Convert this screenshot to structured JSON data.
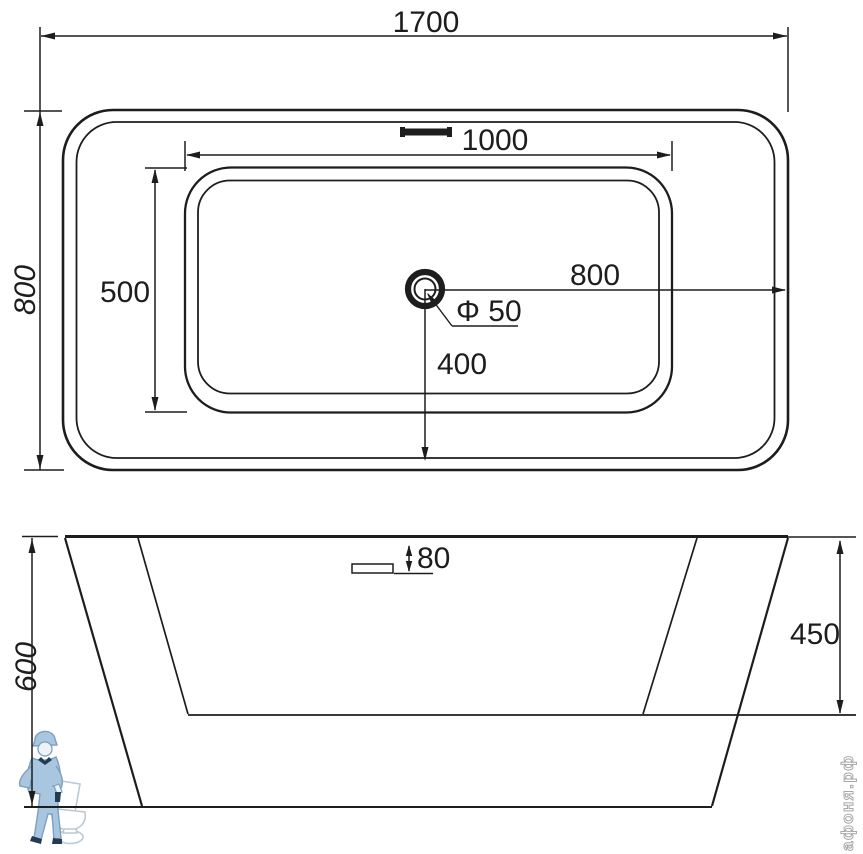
{
  "drawing": {
    "type": "bathtub-technical-drawing",
    "views": {
      "plan": {
        "overall_length": "1700",
        "overall_width": "800",
        "basin_length": "1000",
        "basin_width": "500",
        "drain_offset_right": "800",
        "drain_offset_bottom": "400",
        "drain_diameter": "Φ 50"
      },
      "elevation": {
        "overall_height": "600",
        "basin_depth": "450",
        "overflow_drop": "80"
      }
    },
    "watermark": {
      "site": "афоня.рф",
      "logo": "plumber-with-toilet"
    },
    "colors": {
      "line": "#1d1d1d",
      "background": "#ffffff",
      "watermark_blue": "#a9c6e0",
      "watermark_outline": "#7d9fc0",
      "watermark_dark": "#223c55",
      "watermark_gray": "#bcc9d4",
      "watermark_text_stroke": "#a8a8a8"
    }
  }
}
